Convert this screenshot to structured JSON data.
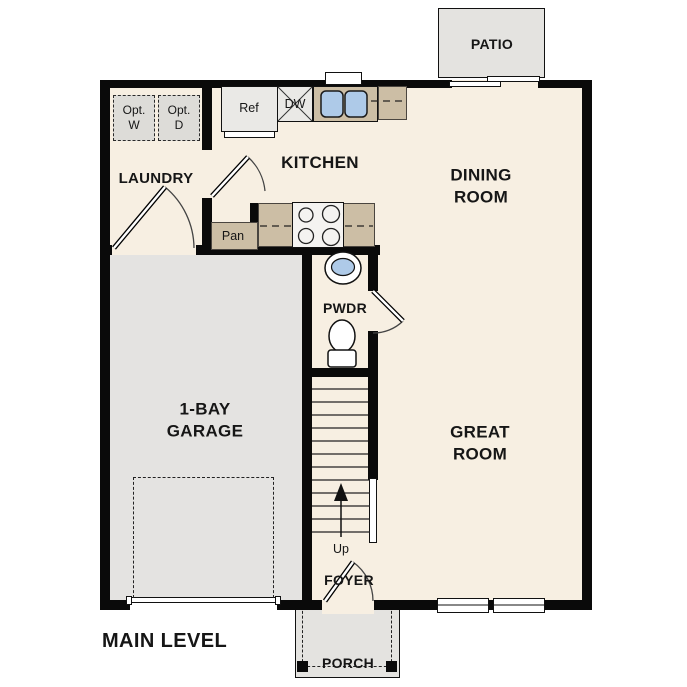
{
  "plan_title": "MAIN LEVEL",
  "rooms": {
    "patio": "PATIO",
    "laundry": "LAUNDRY",
    "kitchen": "KITCHEN",
    "dining_room": "DINING\nROOM",
    "great_room": "GREAT\nROOM",
    "garage": "1-BAY\nGARAGE",
    "powder_room": "PWDR",
    "foyer": "FOYER",
    "porch": "PORCH"
  },
  "fixtures": {
    "refrigerator": "Ref",
    "dishwasher": "DW",
    "pantry": "Pan",
    "optional_washer": "Opt.\nW",
    "optional_dryer": "Opt.\nD",
    "stairs_direction": "Up"
  },
  "colors": {
    "floor": "#f7efe2",
    "exterior_concrete": "#e4e3e0",
    "counter_tan": "#ccbea5",
    "sink_blue": "#aecae8",
    "wall_black": "#0a0a0a",
    "appliance_gray": "#eae9e6",
    "text": "#161616"
  }
}
